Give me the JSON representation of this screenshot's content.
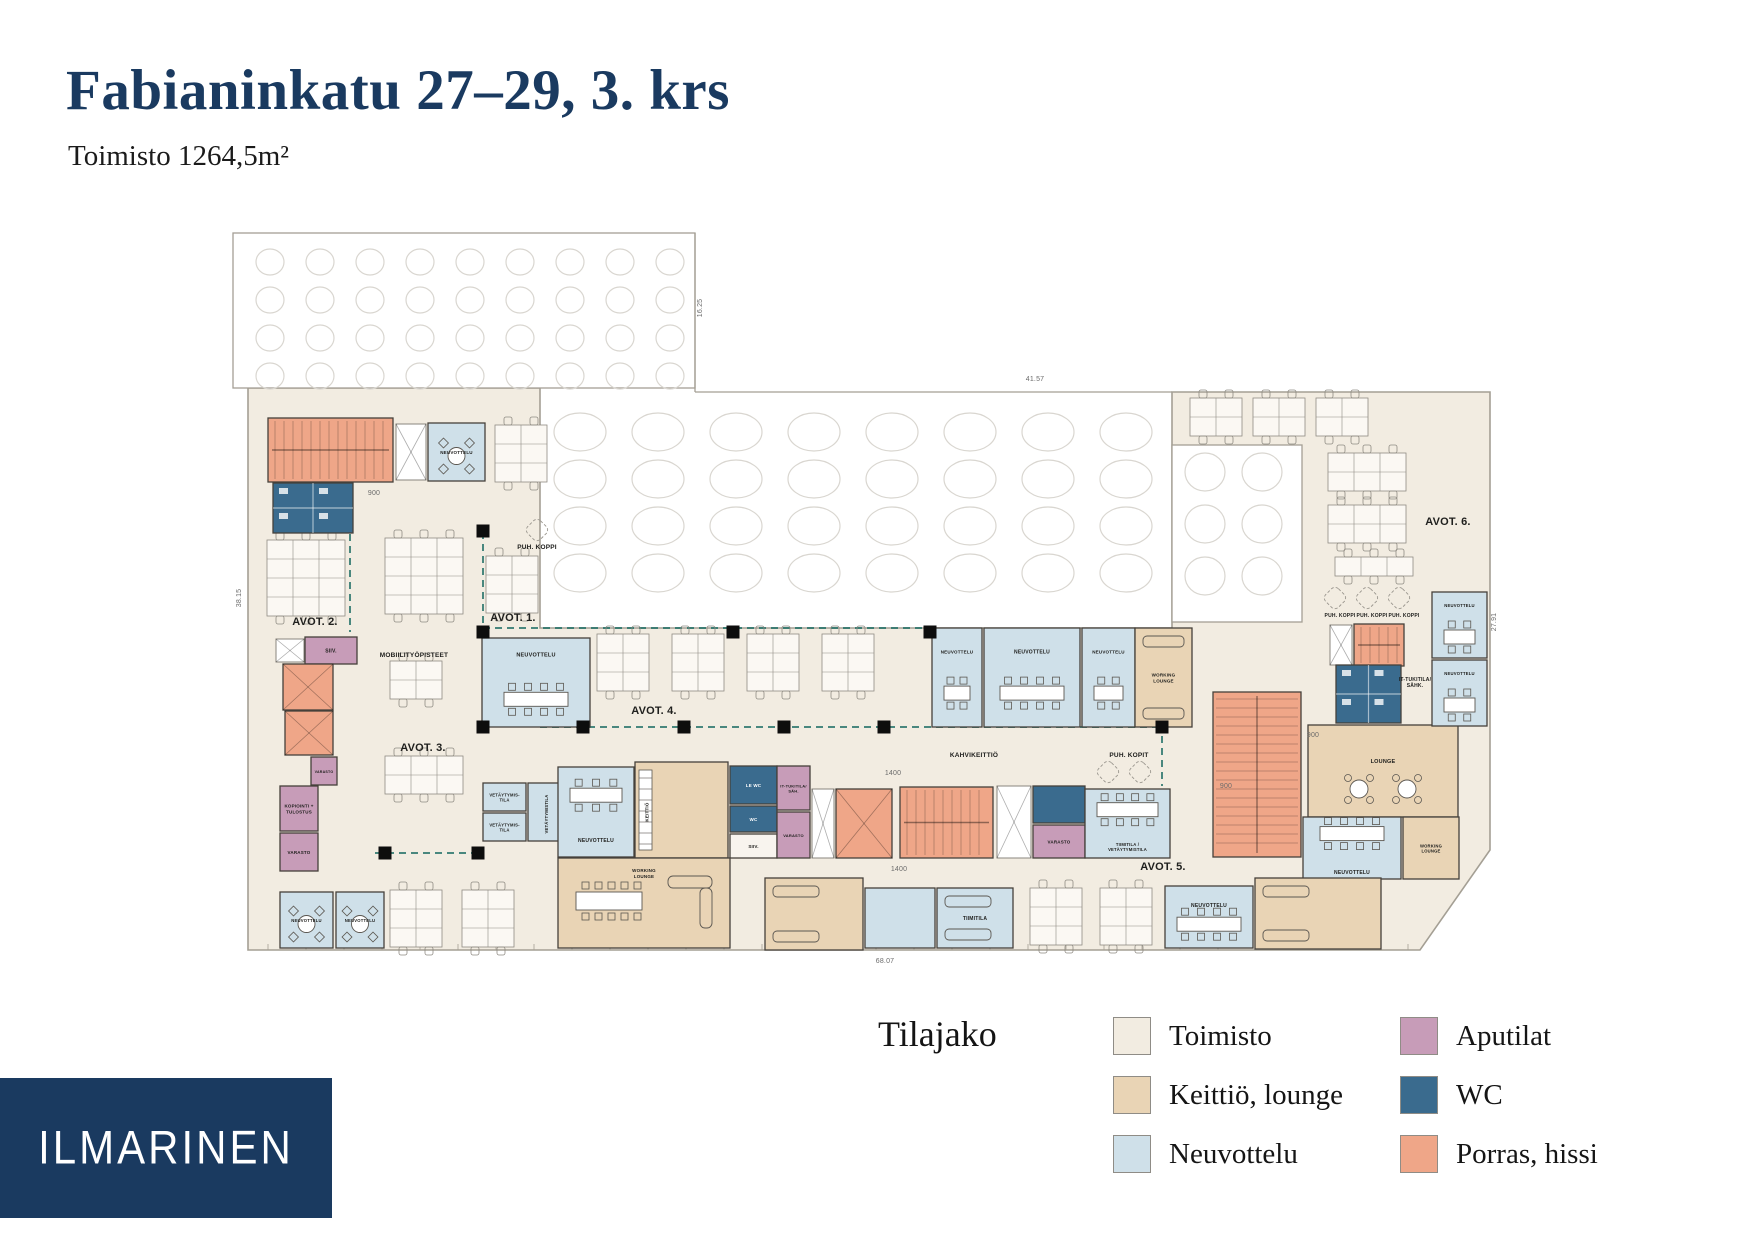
{
  "header": {
    "title": "Fabianinkatu 27–29, 3. krs",
    "subtitle": "Toimisto 1264,5m²"
  },
  "logo": {
    "text": "ILMARINEN"
  },
  "legend": {
    "heading": "Tilajako",
    "items": [
      {
        "label": "Toimisto",
        "color": "#f2ece1"
      },
      {
        "label": "Keittiö, lounge",
        "color": "#e9d4b5"
      },
      {
        "label": "Neuvottelu",
        "color": "#cfe0e9"
      },
      {
        "label": "Aputilat",
        "color": "#c79cb8"
      },
      {
        "label": "WC",
        "color": "#3a6b8e"
      },
      {
        "label": "Porras, hissi",
        "color": "#efa688"
      }
    ]
  },
  "plan": {
    "colors": {
      "toimisto": "#f2ece1",
      "keittio": "#e9d4b5",
      "neuvottelu": "#cfe0e9",
      "aputilat": "#c79cb8",
      "wc": "#3a6b8e",
      "porras": "#efa688",
      "plain": "#f8f4ee",
      "wall": "#45413b",
      "outline": "#a49f94",
      "grid": "#d9d6d0",
      "teal": "#1f6f66",
      "column": "#0d0d0d",
      "label": "#20201e",
      "dim": "#6b6b6b"
    },
    "outer_path": "M248,388 H540 V628 H1172 V392 H1490 V850 L1420,950 H248 Z",
    "white_zones": [
      {
        "x": 233,
        "y": 233,
        "w": 462,
        "h": 155
      },
      {
        "x": 1172,
        "y": 445,
        "w": 130,
        "h": 177
      }
    ],
    "outline_segs": [
      [
        695,
        233,
        695,
        392
      ],
      [
        695,
        392,
        1172,
        392
      ]
    ],
    "circle_zones": [
      {
        "x0": 270,
        "y0": 262,
        "dx": 50,
        "dy": 38,
        "nx": 9,
        "ny": 4,
        "rx": 14,
        "ry": 13
      },
      {
        "x0": 580,
        "y0": 432,
        "dx": 78,
        "dy": 47,
        "nx": 8,
        "ny": 4,
        "rx": 26,
        "ry": 19
      },
      {
        "x0": 1205,
        "y0": 472,
        "dx": 57,
        "dy": 52,
        "nx": 2,
        "ny": 3,
        "rx": 20,
        "ry": 19
      }
    ],
    "teal_walls": [
      [
        350,
        534,
        350,
        632
      ],
      [
        483,
        532,
        483,
        727
      ],
      [
        483,
        628,
        930,
        628
      ],
      [
        540,
        727,
        1160,
        727
      ],
      [
        375,
        853,
        483,
        853
      ],
      [
        1162,
        628,
        1162,
        786
      ]
    ],
    "columns": [
      [
        483,
        531
      ],
      [
        483,
        632
      ],
      [
        483,
        727
      ],
      [
        583,
        727
      ],
      [
        684,
        727
      ],
      [
        784,
        727
      ],
      [
        884,
        727
      ],
      [
        733,
        632
      ],
      [
        930,
        632
      ],
      [
        385,
        853
      ],
      [
        478,
        853
      ],
      [
        1162,
        727
      ]
    ],
    "desks": [
      [
        495,
        425,
        2,
        3
      ],
      [
        267,
        540,
        3,
        4
      ],
      [
        385,
        538,
        3,
        4
      ],
      [
        486,
        556,
        2,
        3
      ],
      [
        390,
        661,
        2,
        2
      ],
      [
        385,
        756,
        3,
        2
      ],
      [
        597,
        634,
        2,
        3
      ],
      [
        672,
        634,
        2,
        3
      ],
      [
        747,
        634,
        2,
        3
      ],
      [
        822,
        634,
        2,
        3
      ],
      [
        390,
        890,
        2,
        3
      ],
      [
        462,
        890,
        2,
        3
      ],
      [
        1030,
        888,
        2,
        3
      ],
      [
        1100,
        888,
        2,
        3
      ],
      [
        1190,
        398,
        2,
        2
      ],
      [
        1253,
        398,
        2,
        2
      ],
      [
        1316,
        398,
        2,
        2
      ],
      [
        1328,
        453,
        3,
        2
      ],
      [
        1328,
        505,
        3,
        2
      ],
      [
        1335,
        557,
        3,
        1
      ]
    ],
    "booths": [
      [
        537,
        530
      ],
      [
        1108,
        772
      ],
      [
        1140,
        772
      ],
      [
        1335,
        598
      ],
      [
        1367,
        598
      ],
      [
        1399,
        598
      ]
    ],
    "rooms": [
      {
        "t": "stairs",
        "x": 268,
        "y": 418,
        "w": 125,
        "h": 64
      },
      {
        "t": "liftw",
        "x": 396,
        "y": 424,
        "w": 30,
        "h": 56
      },
      {
        "t": "neuv",
        "x": 428,
        "y": 423,
        "w": 57,
        "h": 58,
        "l": "NEUVOTTELU",
        "f": "round",
        "ls": 4.5
      },
      {
        "t": "wc",
        "x": 273,
        "y": 483,
        "w": 80,
        "h": 50
      },
      {
        "t": "liftw",
        "x": 276,
        "y": 639,
        "w": 28,
        "h": 23
      },
      {
        "t": "aputila",
        "x": 305,
        "y": 637,
        "w": 52,
        "h": 27,
        "l": "SIIV.",
        "ls": 5
      },
      {
        "t": "lift",
        "x": 283,
        "y": 664,
        "w": 50,
        "h": 46
      },
      {
        "t": "lift",
        "x": 285,
        "y": 711,
        "w": 48,
        "h": 44
      },
      {
        "t": "aputila",
        "x": 311,
        "y": 757,
        "w": 26,
        "h": 28,
        "l": "VARASTO",
        "ls": 3.6
      },
      {
        "t": "aputila",
        "x": 280,
        "y": 786,
        "w": 38,
        "h": 45,
        "l": "KOPIOINTI +\nTULOSTUS",
        "ls": 4.5
      },
      {
        "t": "aputila",
        "x": 280,
        "y": 833,
        "w": 38,
        "h": 38,
        "l": "VARASTO",
        "ls": 4.5
      },
      {
        "t": "neuv",
        "x": 482,
        "y": 638,
        "w": 108,
        "h": 89,
        "l": "NEUVOTTELU",
        "f": "table",
        "lyo": -28,
        "ls": 5.5
      },
      {
        "t": "neuv",
        "x": 932,
        "y": 628,
        "w": 50,
        "h": 99,
        "l": "NEUVOTTELU",
        "f": "table",
        "lyo": -26,
        "ls": 4.5
      },
      {
        "t": "neuv",
        "x": 984,
        "y": 628,
        "w": 96,
        "h": 99,
        "l": "NEUVOTTELU",
        "f": "table",
        "lyo": -26,
        "ls": 5
      },
      {
        "t": "neuv",
        "x": 1082,
        "y": 628,
        "w": 53,
        "h": 99,
        "l": "NEUVOTTELU",
        "f": "table",
        "lyo": -26,
        "ls": 4.5
      },
      {
        "t": "keittio",
        "x": 1135,
        "y": 628,
        "w": 57,
        "h": 99,
        "l": "WORKING\nLOUNGE",
        "f": "sofas",
        "ls": 4.5
      },
      {
        "t": "neuv",
        "x": 483,
        "y": 783,
        "w": 43,
        "h": 28,
        "l": "VETÄYTYMIS-\nTILA",
        "ls": 4.2
      },
      {
        "t": "neuv",
        "x": 483,
        "y": 813,
        "w": 43,
        "h": 28,
        "l": "VETÄYTYMIS-\nTILA",
        "ls": 4.2
      },
      {
        "t": "neuv",
        "x": 528,
        "y": 783,
        "w": 40,
        "h": 58,
        "l": "VETÄYTYMISTILA",
        "v": true,
        "ls": 4.2
      },
      {
        "t": "neuv",
        "x": 558,
        "y": 767,
        "w": 76,
        "h": 90,
        "l": "NEUVOTTELU",
        "f": "table",
        "lyo": 28,
        "ls": 5
      },
      {
        "t": "keittio",
        "x": 635,
        "y": 762,
        "w": 93,
        "h": 96,
        "l": "KEITTIÖ",
        "v": true,
        "lxo": -33,
        "f": "kitchen",
        "ls": 4.5
      },
      {
        "t": "wc",
        "x": 730,
        "y": 766,
        "w": 47,
        "h": 38,
        "l": "LE WC",
        "ls": 4.5
      },
      {
        "t": "wc",
        "x": 730,
        "y": 806,
        "w": 47,
        "h": 26,
        "l": "WC",
        "ls": 4.5
      },
      {
        "t": "plain",
        "x": 730,
        "y": 834,
        "w": 47,
        "h": 24,
        "l": "SIIV.",
        "ls": 4.5
      },
      {
        "t": "aputila",
        "x": 777,
        "y": 766,
        "w": 33,
        "h": 44,
        "l": "IT-TUKITILA/\nSÄH.",
        "ls": 4
      },
      {
        "t": "aputila",
        "x": 777,
        "y": 812,
        "w": 33,
        "h": 46,
        "l": "VARASTO",
        "ls": 4
      },
      {
        "t": "liftw",
        "x": 812,
        "y": 789,
        "w": 22,
        "h": 69
      },
      {
        "t": "lift",
        "x": 836,
        "y": 789,
        "w": 56,
        "h": 69
      },
      {
        "t": "stairs",
        "x": 900,
        "y": 787,
        "w": 93,
        "h": 71
      },
      {
        "t": "liftw",
        "x": 997,
        "y": 786,
        "w": 34,
        "h": 72
      },
      {
        "t": "wc",
        "x": 1033,
        "y": 786,
        "w": 52,
        "h": 37
      },
      {
        "t": "aputila",
        "x": 1033,
        "y": 825,
        "w": 52,
        "h": 33,
        "l": "VARASTO",
        "ls": 4.5
      },
      {
        "t": "neuv",
        "x": 1085,
        "y": 789,
        "w": 85,
        "h": 69,
        "l": "TIIMITILA /\nVETÄYTYMISTILA",
        "f": "table",
        "lyo": 23,
        "ls": 4.2
      },
      {
        "t": "keittio",
        "x": 765,
        "y": 878,
        "w": 98,
        "h": 72,
        "f": "sofas"
      },
      {
        "t": "neuv",
        "x": 865,
        "y": 888,
        "w": 70,
        "h": 60
      },
      {
        "t": "neuv",
        "x": 937,
        "y": 888,
        "w": 76,
        "h": 60,
        "l": "TIIMITILA",
        "f": "sofas",
        "ls": 5
      },
      {
        "t": "keittio",
        "x": 558,
        "y": 858,
        "w": 172,
        "h": 90,
        "l": "WORKING\nLOUNGE",
        "f": "longtable",
        "lyo": -30,
        "ls": 4.5
      },
      {
        "t": "neuv",
        "x": 280,
        "y": 892,
        "w": 53,
        "h": 56,
        "l": "NEUVOTTELU",
        "f": "round",
        "ls": 4.2
      },
      {
        "t": "neuv",
        "x": 336,
        "y": 892,
        "w": 48,
        "h": 56,
        "l": "NEUVOTTELU",
        "f": "round",
        "ls": 4.2
      },
      {
        "t": "neuv",
        "x": 1165,
        "y": 886,
        "w": 88,
        "h": 62,
        "l": "NEUVOTTELU",
        "f": "table",
        "lyo": -12,
        "ls": 5
      },
      {
        "t": "stairs",
        "x": 1213,
        "y": 692,
        "w": 88,
        "h": 165
      },
      {
        "t": "keittio",
        "x": 1308,
        "y": 725,
        "w": 150,
        "h": 92,
        "l": "LOUNGE",
        "f": "round2",
        "lyo": -10,
        "ls": 5.5
      },
      {
        "t": "neuv",
        "x": 1303,
        "y": 817,
        "w": 98,
        "h": 62,
        "l": "NEUVOTTELU",
        "f": "table",
        "lyo": 24,
        "ls": 5
      },
      {
        "t": "keittio",
        "x": 1403,
        "y": 817,
        "w": 56,
        "h": 62,
        "l": "WORKING\nLOUNGE",
        "ls": 4.2
      },
      {
        "t": "keittio",
        "x": 1255,
        "y": 878,
        "w": 126,
        "h": 71,
        "f": "sofas"
      },
      {
        "t": "liftw",
        "x": 1330,
        "y": 625,
        "w": 22,
        "h": 40
      },
      {
        "t": "stairs",
        "x": 1354,
        "y": 624,
        "w": 50,
        "h": 42
      },
      {
        "t": "wc",
        "x": 1336,
        "y": 665,
        "w": 65,
        "h": 58
      },
      {
        "t": "neuv",
        "x": 1432,
        "y": 592,
        "w": 55,
        "h": 66,
        "l": "NEUVOTTELU",
        "f": "table",
        "ls": 4.2,
        "lyo": -20
      },
      {
        "t": "neuv",
        "x": 1432,
        "y": 660,
        "w": 55,
        "h": 66,
        "l": "NEUVOTTELU",
        "f": "table",
        "ls": 4.2,
        "lyo": -20
      }
    ],
    "open_labels": [
      {
        "l": "AVOT. 1.",
        "x": 513,
        "y": 621,
        "s": "avot"
      },
      {
        "l": "AVOT. 2.",
        "x": 315,
        "y": 625,
        "s": "avot"
      },
      {
        "l": "AVOT. 3.",
        "x": 423,
        "y": 751,
        "s": "avot"
      },
      {
        "l": "AVOT. 4.",
        "x": 654,
        "y": 714,
        "s": "avot"
      },
      {
        "l": "AVOT. 5.",
        "x": 1163,
        "y": 870,
        "s": "avot"
      },
      {
        "l": "AVOT. 6.",
        "x": 1448,
        "y": 525,
        "s": "avot"
      },
      {
        "l": "MOBIILITYÖPISTEET",
        "x": 414,
        "y": 657,
        "s": "small"
      },
      {
        "l": "PUH. KOPPI",
        "x": 537,
        "y": 549,
        "s": "small"
      },
      {
        "l": "KAHVIKEITTIÖ",
        "x": 974,
        "y": 757,
        "s": "small"
      },
      {
        "l": "PUH. KOPIT",
        "x": 1129,
        "y": 757,
        "s": "small"
      },
      {
        "l": "PUH. KOPPI",
        "x": 1340,
        "y": 617,
        "s": "tiny"
      },
      {
        "l": "PUH. KOPPI",
        "x": 1372,
        "y": 617,
        "s": "tiny"
      },
      {
        "l": "PUH. KOPPI",
        "x": 1404,
        "y": 617,
        "s": "tiny"
      },
      {
        "l": "IT-TUKITILA/\nSÄHK.",
        "x": 1415,
        "y": 684,
        "s": "tiny"
      }
    ],
    "dims": [
      {
        "l": "900",
        "x": 374,
        "y": 495
      },
      {
        "l": "1400",
        "x": 893,
        "y": 775
      },
      {
        "l": "1400",
        "x": 899,
        "y": 871
      },
      {
        "l": "900",
        "x": 1226,
        "y": 788
      },
      {
        "l": "900",
        "x": 1313,
        "y": 737
      },
      {
        "l": "41.57",
        "x": 1035,
        "y": 381
      },
      {
        "l": "68.07",
        "x": 885,
        "y": 963
      },
      {
        "l": "38.15",
        "x": 241,
        "y": 598,
        "v": true
      },
      {
        "l": "16.25",
        "x": 702,
        "y": 308,
        "v": true
      },
      {
        "l": "27.91",
        "x": 1496,
        "y": 622,
        "v": true
      }
    ]
  }
}
